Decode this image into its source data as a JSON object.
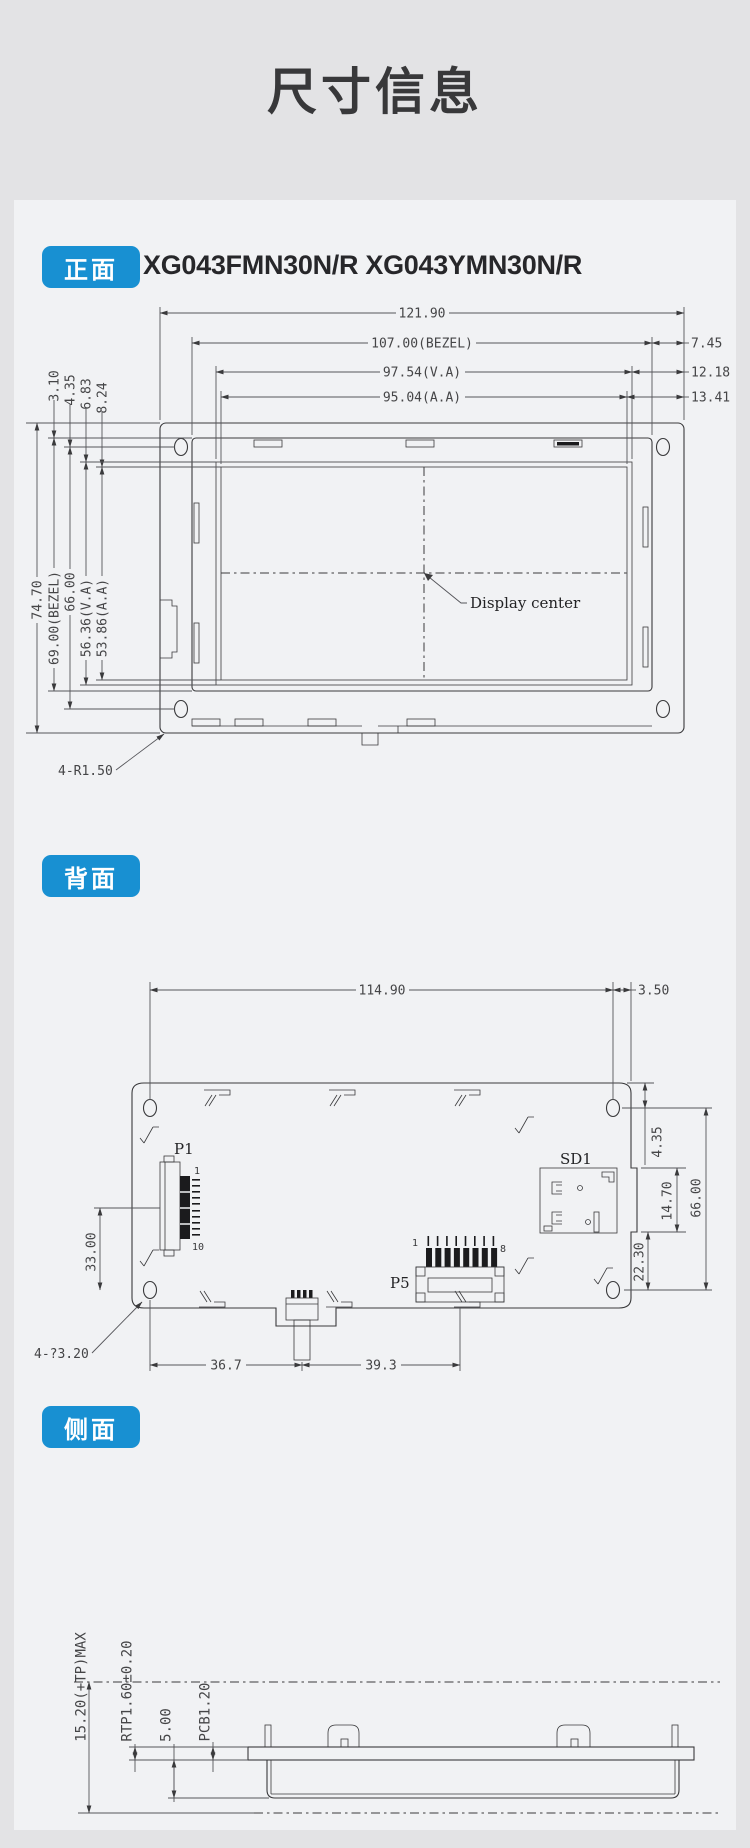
{
  "page": {
    "title": "尺寸信息"
  },
  "front": {
    "badge": "正面",
    "model_title": "XG043FMN30N/R XG043YMN30N/R",
    "dims": {
      "width_total": "121.90",
      "width_bezel": "107.00(BEZEL)",
      "width_va": "97.54(V.A)",
      "width_aa": "95.04(A.A)",
      "right_bezel_edge": "7.45",
      "right_va_edge": "12.18",
      "right_aa_edge": "13.41",
      "top_bezel": "3.10",
      "top_hole": "4.35",
      "top_va": "6.83",
      "top_aa": "8.24",
      "height_total": "74.70",
      "height_bezel": "69.00(BEZEL)",
      "height_holes": "66.00",
      "height_va": "56.36(V.A)",
      "height_aa": "53.86(A.A)",
      "corner_note": "4-R1.50",
      "center_label": "Display center"
    }
  },
  "back": {
    "badge": "背面",
    "dims": {
      "hole_span": "114.90",
      "hole_offset": "3.50",
      "hole_top": "4.35",
      "hole_height": "66.00",
      "sd_height": "14.70",
      "sd_bottom": "22.30",
      "p1_offset": "33.00",
      "hole_note": "4-?3.20",
      "bottom_left": "36.7",
      "bottom_right": "39.3"
    },
    "labels": {
      "p1": "P1",
      "p1_pin_first": "1",
      "p1_pin_last": "10",
      "p5": "P5",
      "p5_pin_first": "1",
      "p5_pin_last": "8",
      "sd": "SD1"
    }
  },
  "side": {
    "badge": "侧面",
    "dims": {
      "total": "15.20(+TP)MAX",
      "rtp": "RTP1.60±0.20",
      "gap": "5.00",
      "pcb": "PCB1.20"
    }
  },
  "colors": {
    "accent": "#1890d2",
    "line": "#3a3a3c"
  }
}
